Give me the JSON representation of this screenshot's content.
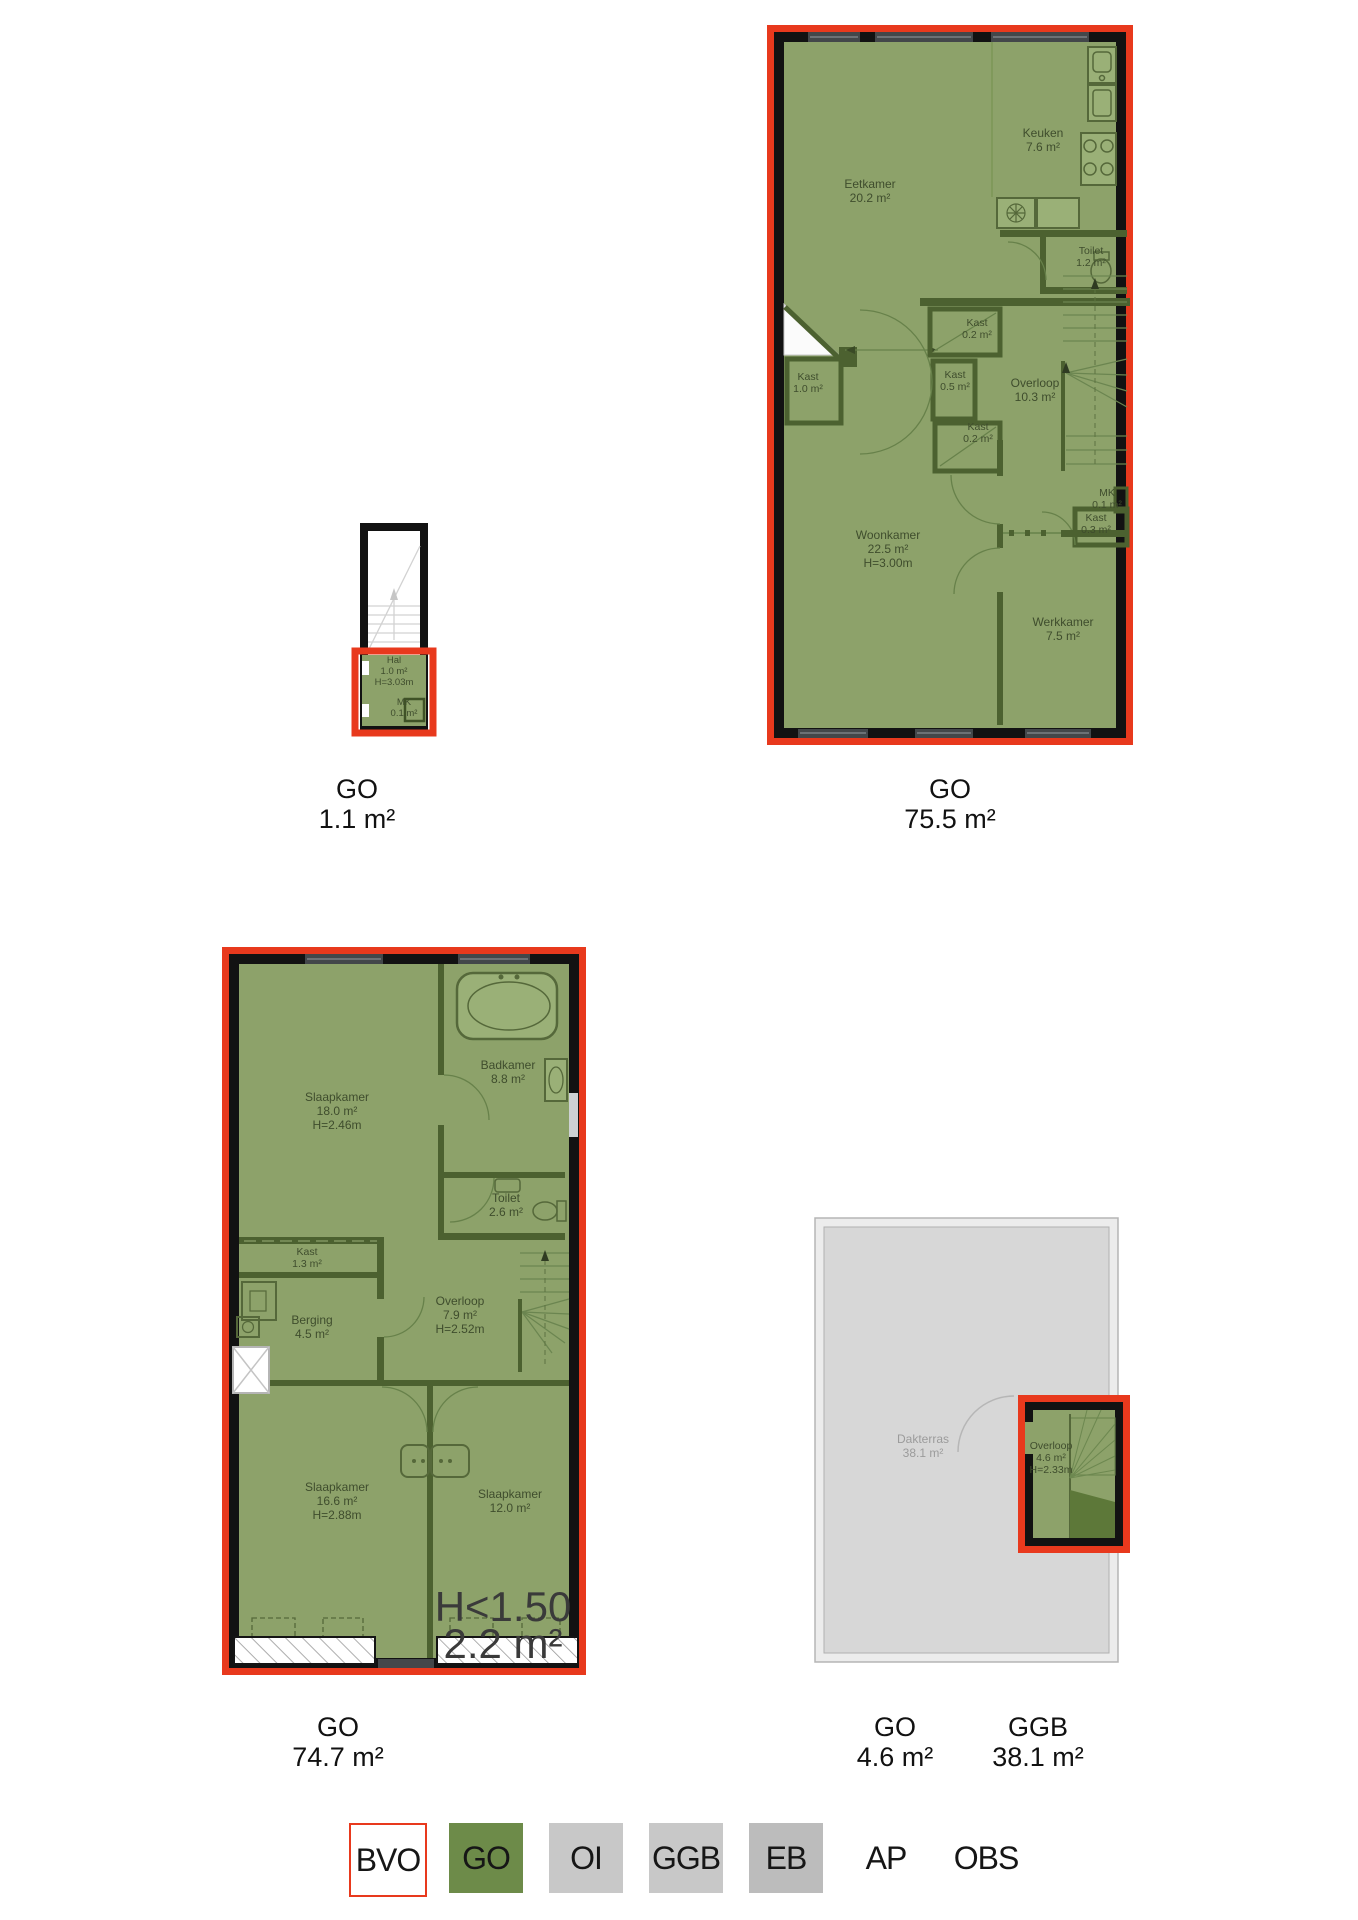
{
  "colors": {
    "bvo_red": "#e8391d",
    "go_fill_green": "#8da26a",
    "go_solid_green": "#6d8b49",
    "wall_dark_green": "#4c6130",
    "wall_black": "#121212",
    "ggb_gray_fill": "#d7d7d7",
    "legend_gray": "#c8c8c8",
    "legend_gray_eb": "#bcbcbc",
    "room_text": "#3f4d2d",
    "gray_text": "#9b9b9b"
  },
  "plans": {
    "stairwell": {
      "caption": {
        "title": "GO",
        "value": "1.1 m²"
      },
      "rooms": {
        "hal": {
          "name": "Hal",
          "area": "1.0 m²",
          "height": "H=3.03m"
        },
        "mk": {
          "name": "MK",
          "area": "0.1 m²"
        }
      }
    },
    "floor1": {
      "caption": {
        "title": "GO",
        "value": "75.5 m²"
      },
      "rooms": {
        "eetkamer": {
          "name": "Eetkamer",
          "area": "20.2 m²"
        },
        "keuken": {
          "name": "Keuken",
          "area": "7.6 m²"
        },
        "toilet": {
          "name": "Toilet",
          "area": "1.2 m²"
        },
        "kast_left": {
          "name": "Kast",
          "area": "1.0 m²"
        },
        "kast_top": {
          "name": "Kast",
          "area": "0.2 m²"
        },
        "kast_mid": {
          "name": "Kast",
          "area": "0.5 m²"
        },
        "kast_bottom": {
          "name": "Kast",
          "area": "0.2 m²"
        },
        "overloop": {
          "name": "Overloop",
          "area": "10.3 m²"
        },
        "mk": {
          "name": "MK",
          "area": "0.1 m²"
        },
        "kast_right": {
          "name": "Kast",
          "area": "0.3 m²"
        },
        "woonkamer": {
          "name": "Woonkamer",
          "area": "22.5 m²",
          "height": "H=3.00m"
        },
        "werkkamer": {
          "name": "Werkkamer",
          "area": "7.5 m²"
        }
      }
    },
    "floor2": {
      "caption": {
        "title": "GO",
        "value": "74.7 m²"
      },
      "rooms": {
        "slaapkamer_1": {
          "name": "Slaapkamer",
          "area": "18.0 m²",
          "height": "H=2.46m"
        },
        "badkamer": {
          "name": "Badkamer",
          "area": "8.8 m²"
        },
        "toilet": {
          "name": "Toilet",
          "area": "2.6 m²"
        },
        "kast": {
          "name": "Kast",
          "area": "1.3 m²"
        },
        "berging": {
          "name": "Berging",
          "area": "4.5 m²"
        },
        "overloop": {
          "name": "Overloop",
          "area": "7.9 m²",
          "height": "H=2.52m"
        },
        "slaapkamer_2": {
          "name": "Slaapkamer",
          "area": "16.6 m²",
          "height": "H=2.88m"
        },
        "slaapkamer_3": {
          "name": "Slaapkamer",
          "area": "12.0 m²"
        },
        "low_headroom": {
          "name": "H<1.50",
          "area": "2.2 m²"
        }
      }
    },
    "roof": {
      "captions": {
        "go": {
          "title": "GO",
          "value": "4.6 m²"
        },
        "ggb": {
          "title": "GGB",
          "value": "38.1 m²"
        }
      },
      "rooms": {
        "dakterras": {
          "name": "Dakterras",
          "area": "38.1 m²"
        },
        "overloop": {
          "name": "Overloop",
          "area": "4.6 m²",
          "height": "H=2.33m"
        }
      }
    }
  },
  "legend": {
    "items": [
      {
        "label": "BVO",
        "fill": "#ffffff",
        "border": "#e8391d"
      },
      {
        "label": "GO",
        "fill": "#6d8b49"
      },
      {
        "label": "OI",
        "fill": "#c8c8c8"
      },
      {
        "label": "GGB",
        "fill": "#c8c8c8"
      },
      {
        "label": "EB",
        "fill": "#bcbcbc"
      },
      {
        "label": "AP",
        "fill": ""
      },
      {
        "label": "OBS",
        "fill": ""
      }
    ]
  }
}
